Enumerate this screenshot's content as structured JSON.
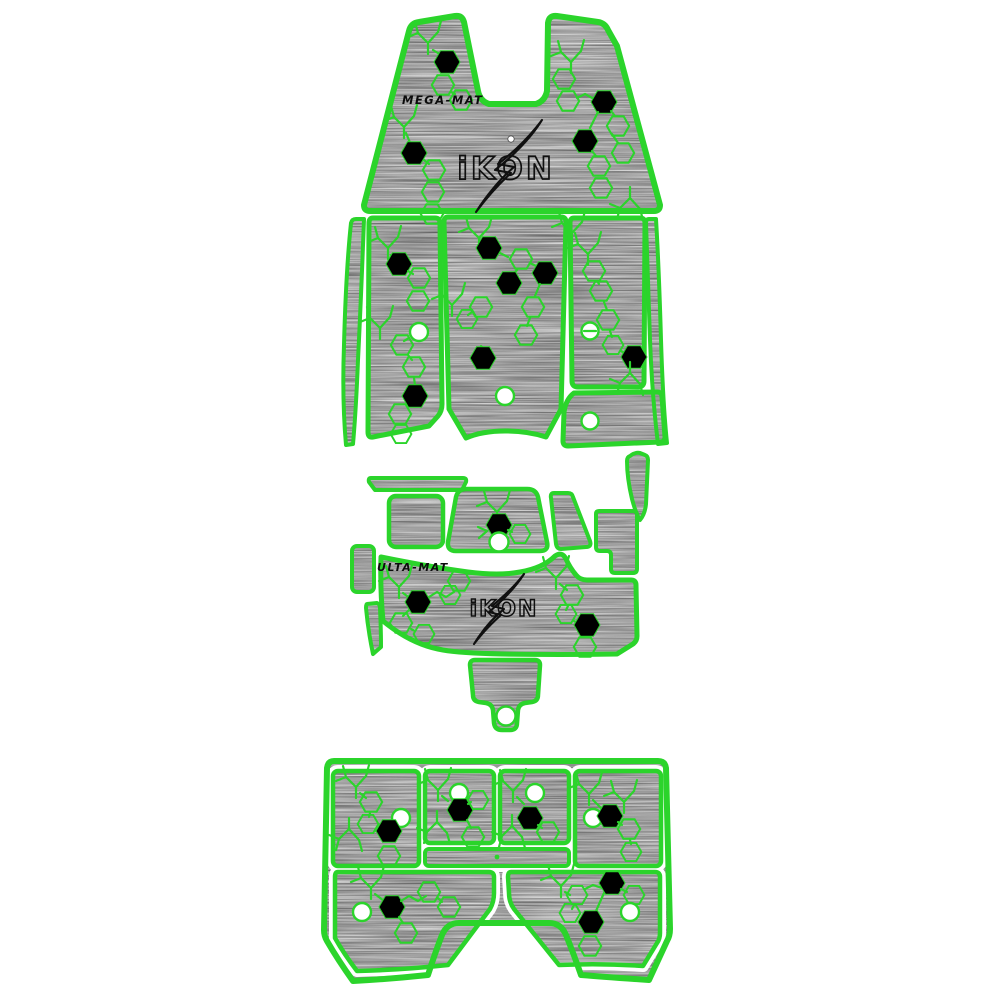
{
  "palette": {
    "accent_green": "#2bd42b",
    "mat_gray": "#8e8e8e",
    "hexagon_black": "#000000",
    "cutout_white": "#ffffff",
    "logo_outline_black": "#101010",
    "background": "#ffffff"
  },
  "mats": {
    "bow_mat": {
      "brand_label": "MEGA-MAT",
      "logo_text": "iKON"
    },
    "console_mat": {
      "brand_label": "ULTA-MAT",
      "logo_text": "iKON"
    }
  },
  "sections": [
    "bow-mat",
    "cockpit-side-sliver-port",
    "cockpit-floor-port-panel",
    "cockpit-floor-center-panel",
    "cockpit-floor-starboard-top-panel",
    "cockpit-floor-starboard-bottom-panel",
    "cockpit-side-sliver-starboard",
    "console-trim-bar",
    "console-square-pad",
    "console-left-rect",
    "console-left-sliver",
    "console-top-trapezoid",
    "console-right-wedge",
    "console-right-blade",
    "console-right-step",
    "console-main-mat",
    "step-tab-pad",
    "swim-platform-mat"
  ],
  "counts": {
    "black_hexagons": 16,
    "white_cutouts": 12
  }
}
